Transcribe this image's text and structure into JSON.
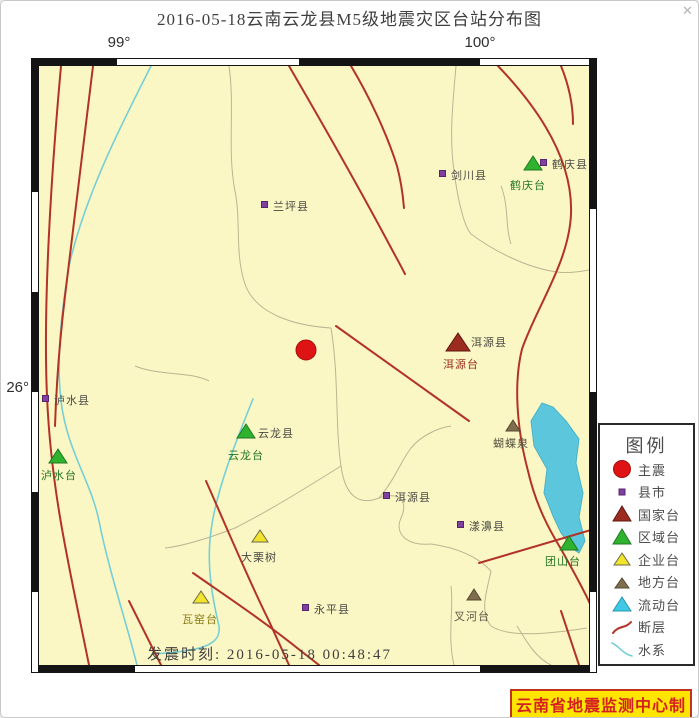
{
  "window": {
    "title": "2016-05-18云南云龙县M5级地震灾区台站分布图",
    "close": "✕"
  },
  "axis": {
    "lon_left": "99°",
    "lon_right": "100°",
    "lat_left": "26°"
  },
  "map": {
    "event_time": "发震时刻: 2016-05-18 00:48:47",
    "markers": [
      {
        "label": "剑川县",
        "type": "county"
      },
      {
        "label": "鹤庆县",
        "type": "county"
      },
      {
        "label": "鹤庆台",
        "type": "regional-station"
      },
      {
        "label": "兰坪县",
        "type": "county"
      },
      {
        "label": "洱源县",
        "sublabel": "洱源台",
        "type": "national-station"
      },
      {
        "label": "",
        "type": "mainshock"
      },
      {
        "label": "泸水县",
        "type": "county"
      },
      {
        "label": "泸水台",
        "type": "regional-station"
      },
      {
        "label": "云龙县",
        "sublabel": "云龙台",
        "type": "regional-station"
      },
      {
        "label": "蝴蝶泉",
        "type": "local-station"
      },
      {
        "label": "洱源县",
        "type": "county"
      },
      {
        "label": "漾濞县",
        "type": "county"
      },
      {
        "label": "大栗树",
        "type": "enterprise-station"
      },
      {
        "label": "瓦窑台",
        "type": "enterprise-station"
      },
      {
        "label": "永平县",
        "type": "county"
      },
      {
        "label": "叉河台",
        "type": "local-station"
      },
      {
        "label": "团山台",
        "type": "regional-station"
      }
    ]
  },
  "legend": {
    "title": "图例",
    "items": [
      {
        "label": "主震",
        "symbol": "mainshock-circle"
      },
      {
        "label": "县市",
        "symbol": "county-square"
      },
      {
        "label": "国家台",
        "symbol": "national-triangle"
      },
      {
        "label": "区域台",
        "symbol": "regional-triangle"
      },
      {
        "label": "企业台",
        "symbol": "enterprise-triangle"
      },
      {
        "label": "地方台",
        "symbol": "local-triangle"
      },
      {
        "label": "流动台",
        "symbol": "mobile-triangle"
      },
      {
        "label": "断层",
        "symbol": "fault-line"
      },
      {
        "label": "水系",
        "symbol": "river-line"
      }
    ]
  },
  "credit": "云南省地震监测中心制",
  "colors": {
    "map_bg": "#FBF7C5",
    "fault": "#B33226",
    "river": "#74CFD6",
    "lake": "#5CC6DC",
    "mainshock": "#DE1414",
    "county": "#8040A0",
    "national": "#9C2B20",
    "regional": "#2FB32F",
    "enterprise": "#F2E32B",
    "local": "#7E6E4E",
    "mobile": "#3FC9E6",
    "credit_bg": "#FFE500",
    "credit_text": "#D42020"
  }
}
